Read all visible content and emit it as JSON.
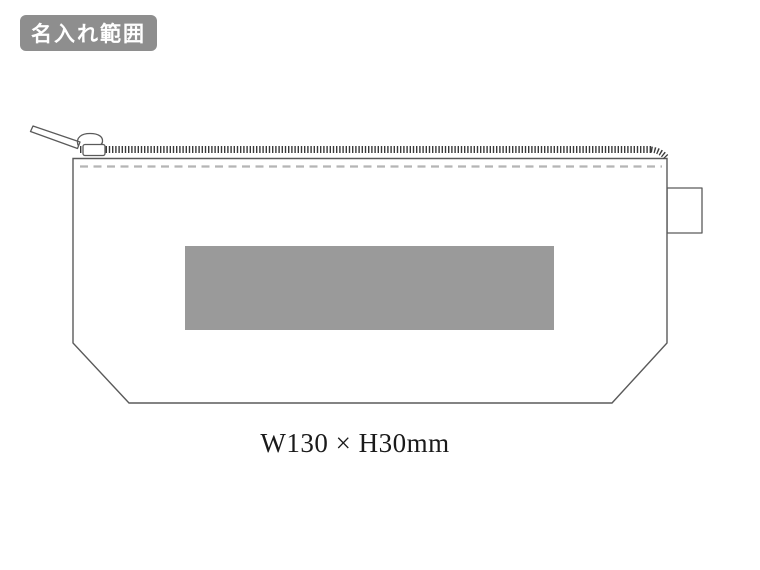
{
  "badge": {
    "label": "名入れ範囲"
  },
  "diagram": {
    "item": "zipper-pouch-imprint-area-diagram",
    "size_label": "W130 × H30mm"
  },
  "colors": {
    "badge_bg": "#8e8e8e",
    "badge_text": "#ffffff",
    "outline": "#5a5a5a",
    "zipper_teeth": "#3a3a3a",
    "stitch_line": "#b5b5b5",
    "print_area": "#9a9a9a",
    "size_text": "#1a1a1a",
    "background": "#ffffff"
  }
}
